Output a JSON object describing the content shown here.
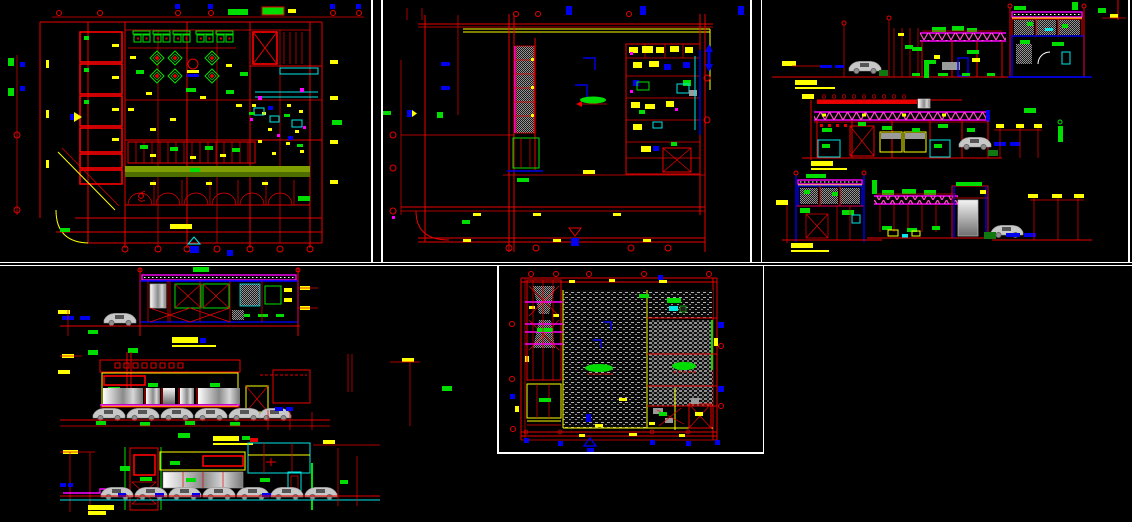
{
  "document": {
    "kind": "cad-drawing-sheet",
    "background_color": "#000000",
    "divider_color": "#ffffff",
    "description": "Black-background CAD sheet preview with five viewports of a restaurant/commercial building project"
  },
  "palette": {
    "red": "#e80000",
    "yellow": "#ffff00",
    "green": "#00dd00",
    "cyan": "#00e8e8",
    "blue": "#0000ee",
    "magenta": "#ff00ff",
    "pink_truss": "#ff50c8",
    "white": "#ffffff",
    "gray_glass": "#9a9a9a",
    "olive_band": "#7f9f00",
    "dark_olive": "#4e6e00",
    "car_gray": "#c8c8c8"
  },
  "panels": [
    {
      "id": "ground-floor-plan",
      "label": "Ground floor plan: left room block, booth seating, diamond planters, kitchen line, olive service band, parking bays with arcs, corner road curve, red column grid with bubbles",
      "title_mark": {
        "type": "title-bar",
        "color": "#ffff00",
        "legible": false
      }
    },
    {
      "id": "upper-floor-plan",
      "label": "Upper floor plan: L-shaped grid, gray hatched mezzanine strip with magenta edge, green stair run, open double-height hall, furniture cluster at right, grid bubbles",
      "title_mark": {
        "type": "title-bar",
        "color": "#ffff00",
        "legible": false
      }
    },
    {
      "id": "elevations-right-sheet",
      "label": "Three elevations/sections: magenta pipe trusses, red roof band with light fittings, gray tank, hatched window bands, counters, parked cars, grid lines with dimension ticks",
      "title_marks": [
        {
          "type": "title-bar",
          "color": "#ffff00",
          "legible": false
        },
        {
          "type": "title-bar",
          "color": "#ffff00",
          "legible": false
        },
        {
          "type": "title-bar",
          "color": "#ffff00",
          "legible": false
        }
      ]
    },
    {
      "id": "elevations-left-sheet",
      "label": "Longitudinal section with X-braced bays and three storefront elevations: gradient glass panels, red window row, sign boards, rows of parked cars, ground lines",
      "title_marks": [
        {
          "type": "title-bar",
          "color": "#ffff00",
          "legible": false
        },
        {
          "type": "title-bar",
          "color": "#ffff00",
          "legible": false
        },
        {
          "type": "title-bar",
          "color": "#ffff00",
          "legible": false
        }
      ]
    },
    {
      "id": "roof-plan",
      "label": "Roof plan: stippled roofing hatch, denser hatch zone at right, X-braced service tower with magenta beams, stair, equipment room, north arrow, grid bubbles",
      "title_mark": {
        "type": "north-arrow",
        "color": "#0000ee",
        "legible": false
      }
    }
  ],
  "annotations": {
    "yellow_marks": "dimension ticks and highlighted drawing titles (text too small to resolve)",
    "green_marks": "room/level annotation text blocks (text too small to resolve)",
    "grid_bubbles": "red circles and blue square/diamond markers at grid line ends"
  }
}
